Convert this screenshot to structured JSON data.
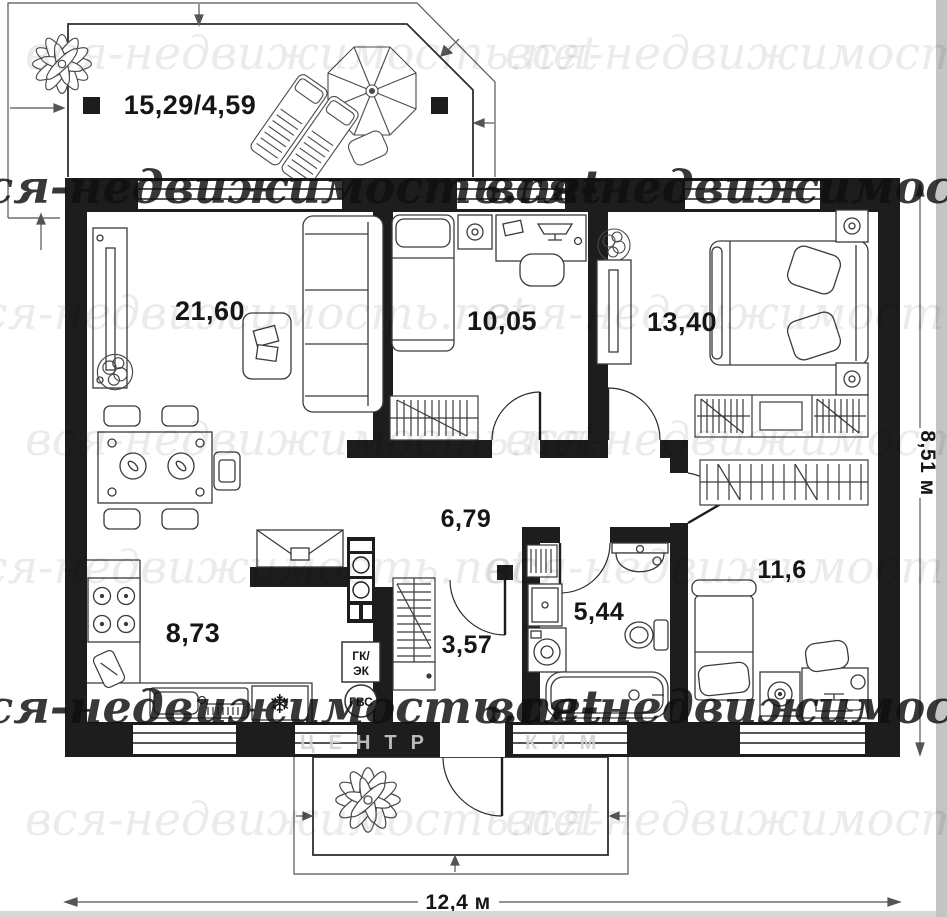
{
  "watermark": {
    "script": "вся-недвижимость.net",
    "caps_left": "ЦЕНТР",
    "caps_right": "КИМ"
  },
  "rooms": {
    "terrace": "15,29/4,59",
    "living": "21,60",
    "bedroom_small": "10,05",
    "bedroom_master": "13,40",
    "hallway": "6,79",
    "kitchen": "8,73",
    "corridor": "3,57",
    "bathroom": "5,44",
    "bedroom_third": "11,6"
  },
  "dimensions": {
    "width": "12,4 м",
    "height": "8,51 м"
  },
  "tech": {
    "gk_line1": "ГК/",
    "gk_line2": "ЭК",
    "gvs": "ГВС"
  },
  "icons": {
    "snowflake": "❄"
  },
  "symbol_names": [
    "plant-icon",
    "umbrella-icon",
    "lounger-icon",
    "sofa-icon",
    "tv-icon",
    "bed-icon",
    "wardrobe-icon",
    "bathtub-icon",
    "toilet-icon",
    "sink-icon",
    "washing-machine-icon",
    "stove-icon",
    "fridge-icon",
    "dining-table-icon",
    "desk-icon",
    "door-arc-icon",
    "towel-radiator-icon"
  ],
  "colors": {
    "wall": "#1d1d1d",
    "line": "#3a3a3a",
    "watermark_light": "rgba(0,0,0,0.08)",
    "watermark_dark": "rgba(16,16,16,0.83)"
  }
}
